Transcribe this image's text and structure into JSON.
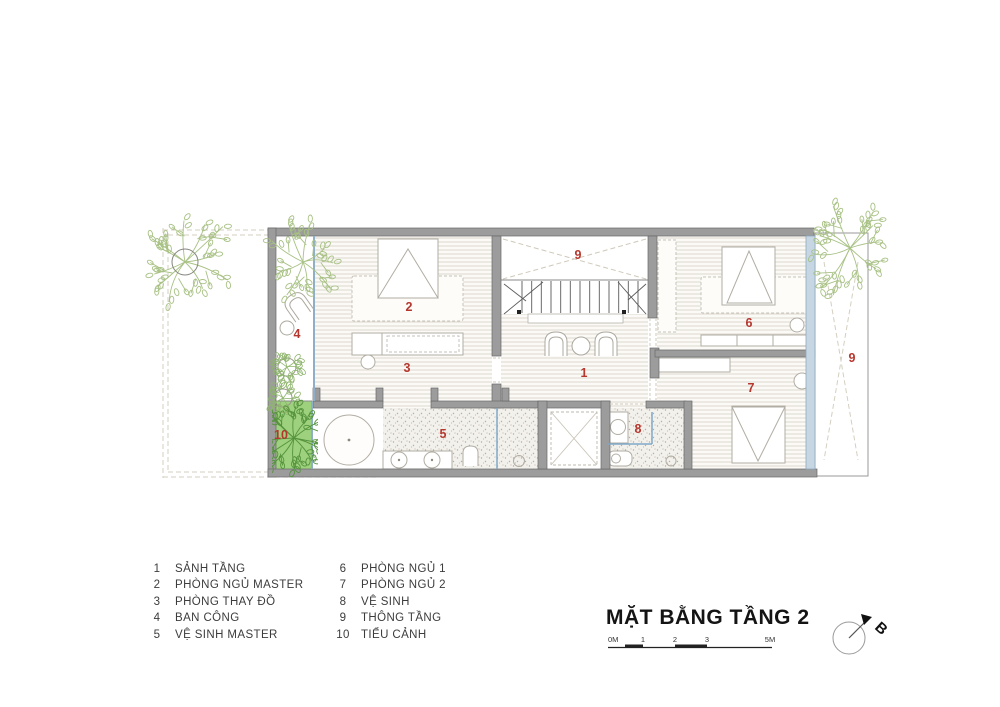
{
  "legend": {
    "items": [
      {
        "num": "1",
        "label": "SẢNH TẦNG"
      },
      {
        "num": "2",
        "label": "PHÒNG NGỦ MASTER"
      },
      {
        "num": "3",
        "label": "PHÒNG THAY ĐỒ"
      },
      {
        "num": "4",
        "label": "BAN CÔNG"
      },
      {
        "num": "5",
        "label": "VỆ SINH MASTER"
      },
      {
        "num": "6",
        "label": "PHÒNG NGỦ 1"
      },
      {
        "num": "7",
        "label": "PHÒNG NGỦ 2"
      },
      {
        "num": "8",
        "label": "VỆ SINH"
      },
      {
        "num": "9",
        "label": "THÔNG TẦNG"
      },
      {
        "num": "10",
        "label": "TIỂU CẢNH"
      }
    ]
  },
  "title_block": {
    "title": "MẶT BẰNG TẦNG 2",
    "scale_labels": [
      "0M",
      "1",
      "2",
      "3",
      "5M"
    ]
  },
  "compass": {
    "north_label": "B"
  },
  "colors": {
    "room_number_red": "#b5372e",
    "wall_gray": "#9c9c9c",
    "garden_green": "#9ed17d",
    "glass_blue": "#7fa8c8",
    "tree_green": "#a8c184"
  }
}
